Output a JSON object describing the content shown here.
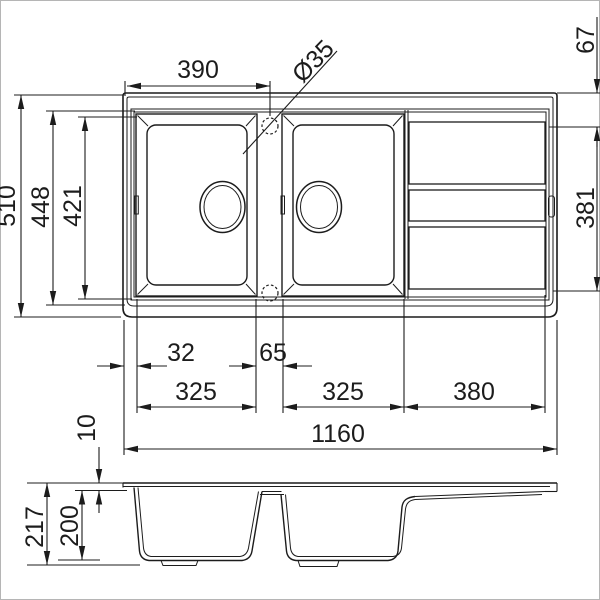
{
  "drawing": {
    "type": "kitchen-sink technical drawing, top view and section view",
    "colors": {
      "line": "#1c1c1c",
      "background": "#ffffff",
      "frame": "#b5b5b5"
    }
  },
  "dims": {
    "top": {
      "bowl_span": "390",
      "tap_hole": "Ø35",
      "edge_to_drainer": "67",
      "overall_depth": "510",
      "inner_depth": "448",
      "recess_depth": "421",
      "drainer_depth": "381",
      "rim_offset": "32",
      "bowl_gap": "65",
      "bowl1_width": "325",
      "bowl2_width": "325",
      "drainer_width": "380",
      "overall_width": "1160"
    },
    "side": {
      "rim_height": "10",
      "total_height": "217",
      "bowl_depth": "200"
    }
  }
}
